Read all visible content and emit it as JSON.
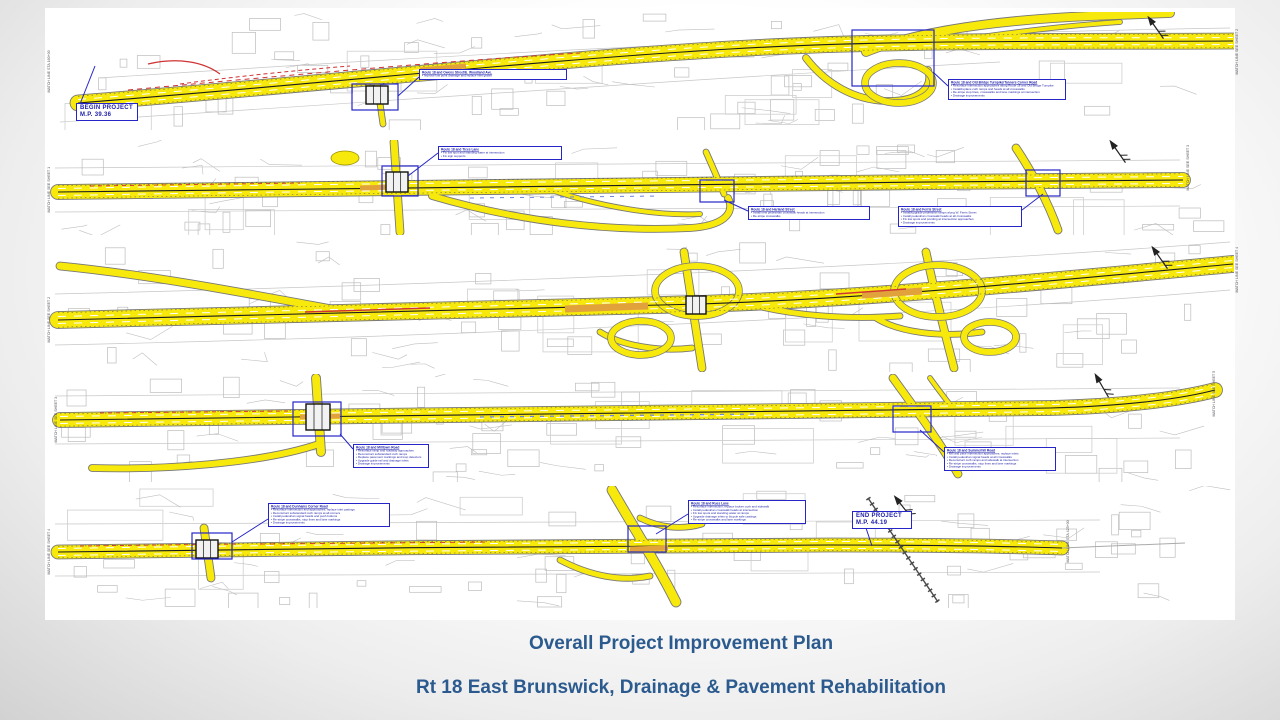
{
  "slide": {
    "title_line1": "Overall Project Improvement Plan",
    "title_line2": "Rt 18 East Brunswick, Drainage & Pavement Rehabilitation"
  },
  "colors": {
    "title_blue": "#2b5a8f",
    "annotation_blue": "#2525c8",
    "road_yellow": "#f7e90c",
    "road_outline": "#777777",
    "highlight_orange": "#e2a23b",
    "accent_red": "#cf3333"
  },
  "plan": {
    "begin_marker": {
      "line1": "BEGIN PROJECT",
      "line2": "M.P. 39.36"
    },
    "end_marker": {
      "line1": "END PROJECT",
      "line2": "M.P. 44.19"
    },
    "callouts": [
      {
        "id": "s1-woodland",
        "title": "Route 18 and Owens Street/E. Woodland Ave.",
        "bullets": [
          "Improve low point drainage and replace inlet grates"
        ]
      },
      {
        "id": "s1-old-bridge",
        "title": "Route 18 and Old Bridge Turnpike/Tanners Corner Road",
        "bullets": [
          "Resurface intersection approaches along Route 18 and Old Bridge Turnpike",
          "Install/replace curb ramps and heads at all crosswalks",
          "Re-stripe stop lines, crosswalks and lane markings at intersection",
          "Drainage improvements"
        ]
      },
      {
        "id": "s2-tices",
        "title": "Route 18 and Tices Lane",
        "bullets": [
          "Fix low spot and standing water at intersection",
          "Fix sign supports"
        ]
      },
      {
        "id": "s2-harland",
        "title": "Route 18 and Harland Street",
        "bullets": [
          "Install new pedestrian crosswalk heads at intersection",
          "Re-stripe crosswalks"
        ]
      },
      {
        "id": "s2-ferris",
        "title": "Route 18 and Ferris Street",
        "bullets": [
          "Install/upgrade pedestrian ramps along W. Ferris Street",
          "Install pedestrian crosswalk heads at all crosswalks",
          "Fix low spots and ponding at intersection approaches",
          "Drainage improvements"
        ]
      },
      {
        "id": "s4-milltown",
        "title": "Route 18 and Milltown Road",
        "bullets": [
          "Resurface ramp and roadway approaches",
          "Reconstruct substandard curb ramps",
          "Replace pavement markings and loop detectors",
          "Upgrade guide rail and drainage inlets",
          "Drainage improvements"
        ]
      },
      {
        "id": "s4-summerhill",
        "title": "Route 18 and Summerhill Road",
        "bullets": [
          "Mill and pave intersection approaches; replace inlets",
          "Install pedestrian signal heads at all crosswalks",
          "Reconstruct curb ramps and sidewalk at intersection",
          "Re-stripe crosswalks, stop lines and lane markings",
          "Drainage improvements"
        ]
      },
      {
        "id": "s5-dunhams",
        "title": "Route 18 and Dunhams Corner Road",
        "bullets": [
          "Resurface intersection and approaches; replace inlet castings",
          "Reconstruct substandard curb ramps at all corners",
          "Install pedestrian signal heads and push buttons",
          "Re-stripe crosswalks, stop lines and lane markings",
          "Drainage improvements"
        ]
      },
      {
        "id": "s5-rues",
        "title": "Route 18 and Rues Lane",
        "bullets": [
          "Resurface intersection; replace broken curb and sidewalk",
          "Install pedestrian crosswalk heads at intersection",
          "Fix low spots and standing water at ramps",
          "Upgrade drainage inlets to bicycle safe castings",
          "Re-stripe crosswalks and lane markings"
        ]
      }
    ],
    "matchline_labels": [
      "MATCH LINE STA 160+00",
      "MATCH LINE SEE SHEET 2",
      "MATCH LINE SEE SHEET 1",
      "MATCH LINE SEE SHEET 3",
      "MATCH LINE SEE SHEET 2",
      "MATCH LINE SEE SHEET 4",
      "MATCH LINE SEE SHEET 3",
      "MATCH LINE SEE SHEET 5",
      "MATCH LINE SEE SHEET 4",
      "MATCH LINE STA 425+00"
    ]
  }
}
